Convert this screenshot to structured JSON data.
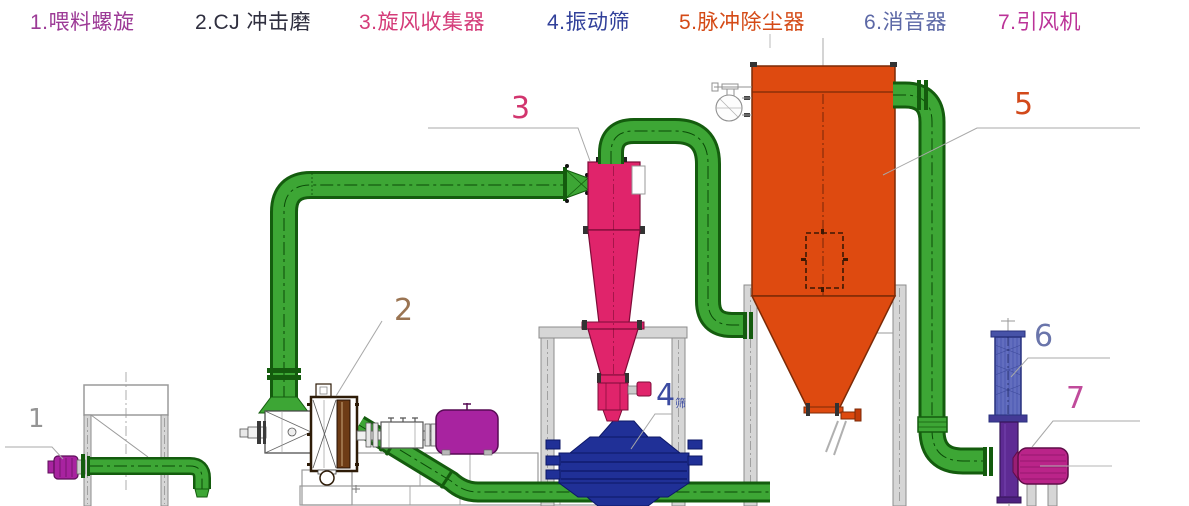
{
  "title": "粉碎系统流程图 (grinding system diagram)",
  "legend": {
    "items": [
      {
        "label": "1.喂料螺旋",
        "name": "feed-screw",
        "color": "#9c3a96"
      },
      {
        "label": "2.CJ 冲击磨",
        "name": "cj-impact-mill",
        "color": "#2f2f3f"
      },
      {
        "label": "3.旋风收集器",
        "name": "cyclone-collector",
        "color": "#d43b78"
      },
      {
        "label": "4.振动筛",
        "name": "vibrating-screen",
        "color": "#31409a"
      },
      {
        "label": "5.脉冲除尘器",
        "name": "pulse-dust-collector",
        "color": "#d44a16"
      },
      {
        "label": "6.消音器",
        "name": "muffler",
        "color": "#5c68a6"
      },
      {
        "label": "7.引风机",
        "name": "induced-draft-fan",
        "color": "#bb3398"
      }
    ]
  },
  "callouts": [
    {
      "num": "1",
      "color": "#949494"
    },
    {
      "num": "2",
      "color": "#9a7452"
    },
    {
      "num": "3",
      "color": "#d2356e"
    },
    {
      "num": "4",
      "suffix": "筛",
      "color": "#3b4ba1"
    },
    {
      "num": "5",
      "color": "#d2491a"
    },
    {
      "num": "6",
      "color": "#6a75ab"
    },
    {
      "num": "7",
      "color": "#c04b9b"
    }
  ],
  "colors": {
    "pipe_green": "#3da635",
    "pipe_outline": "#145c0e",
    "cyclone_pink": "#e0246b",
    "collector_orange": "#de4a10",
    "screen_blue": "#203097",
    "motor_purple": "#a823a0",
    "fan_magenta": "#ba2489",
    "muffler_blue": "#5763b8",
    "duct_purple": "#5e2b94",
    "structure_gray": "#d6d6d6",
    "background": "#ffffff"
  }
}
